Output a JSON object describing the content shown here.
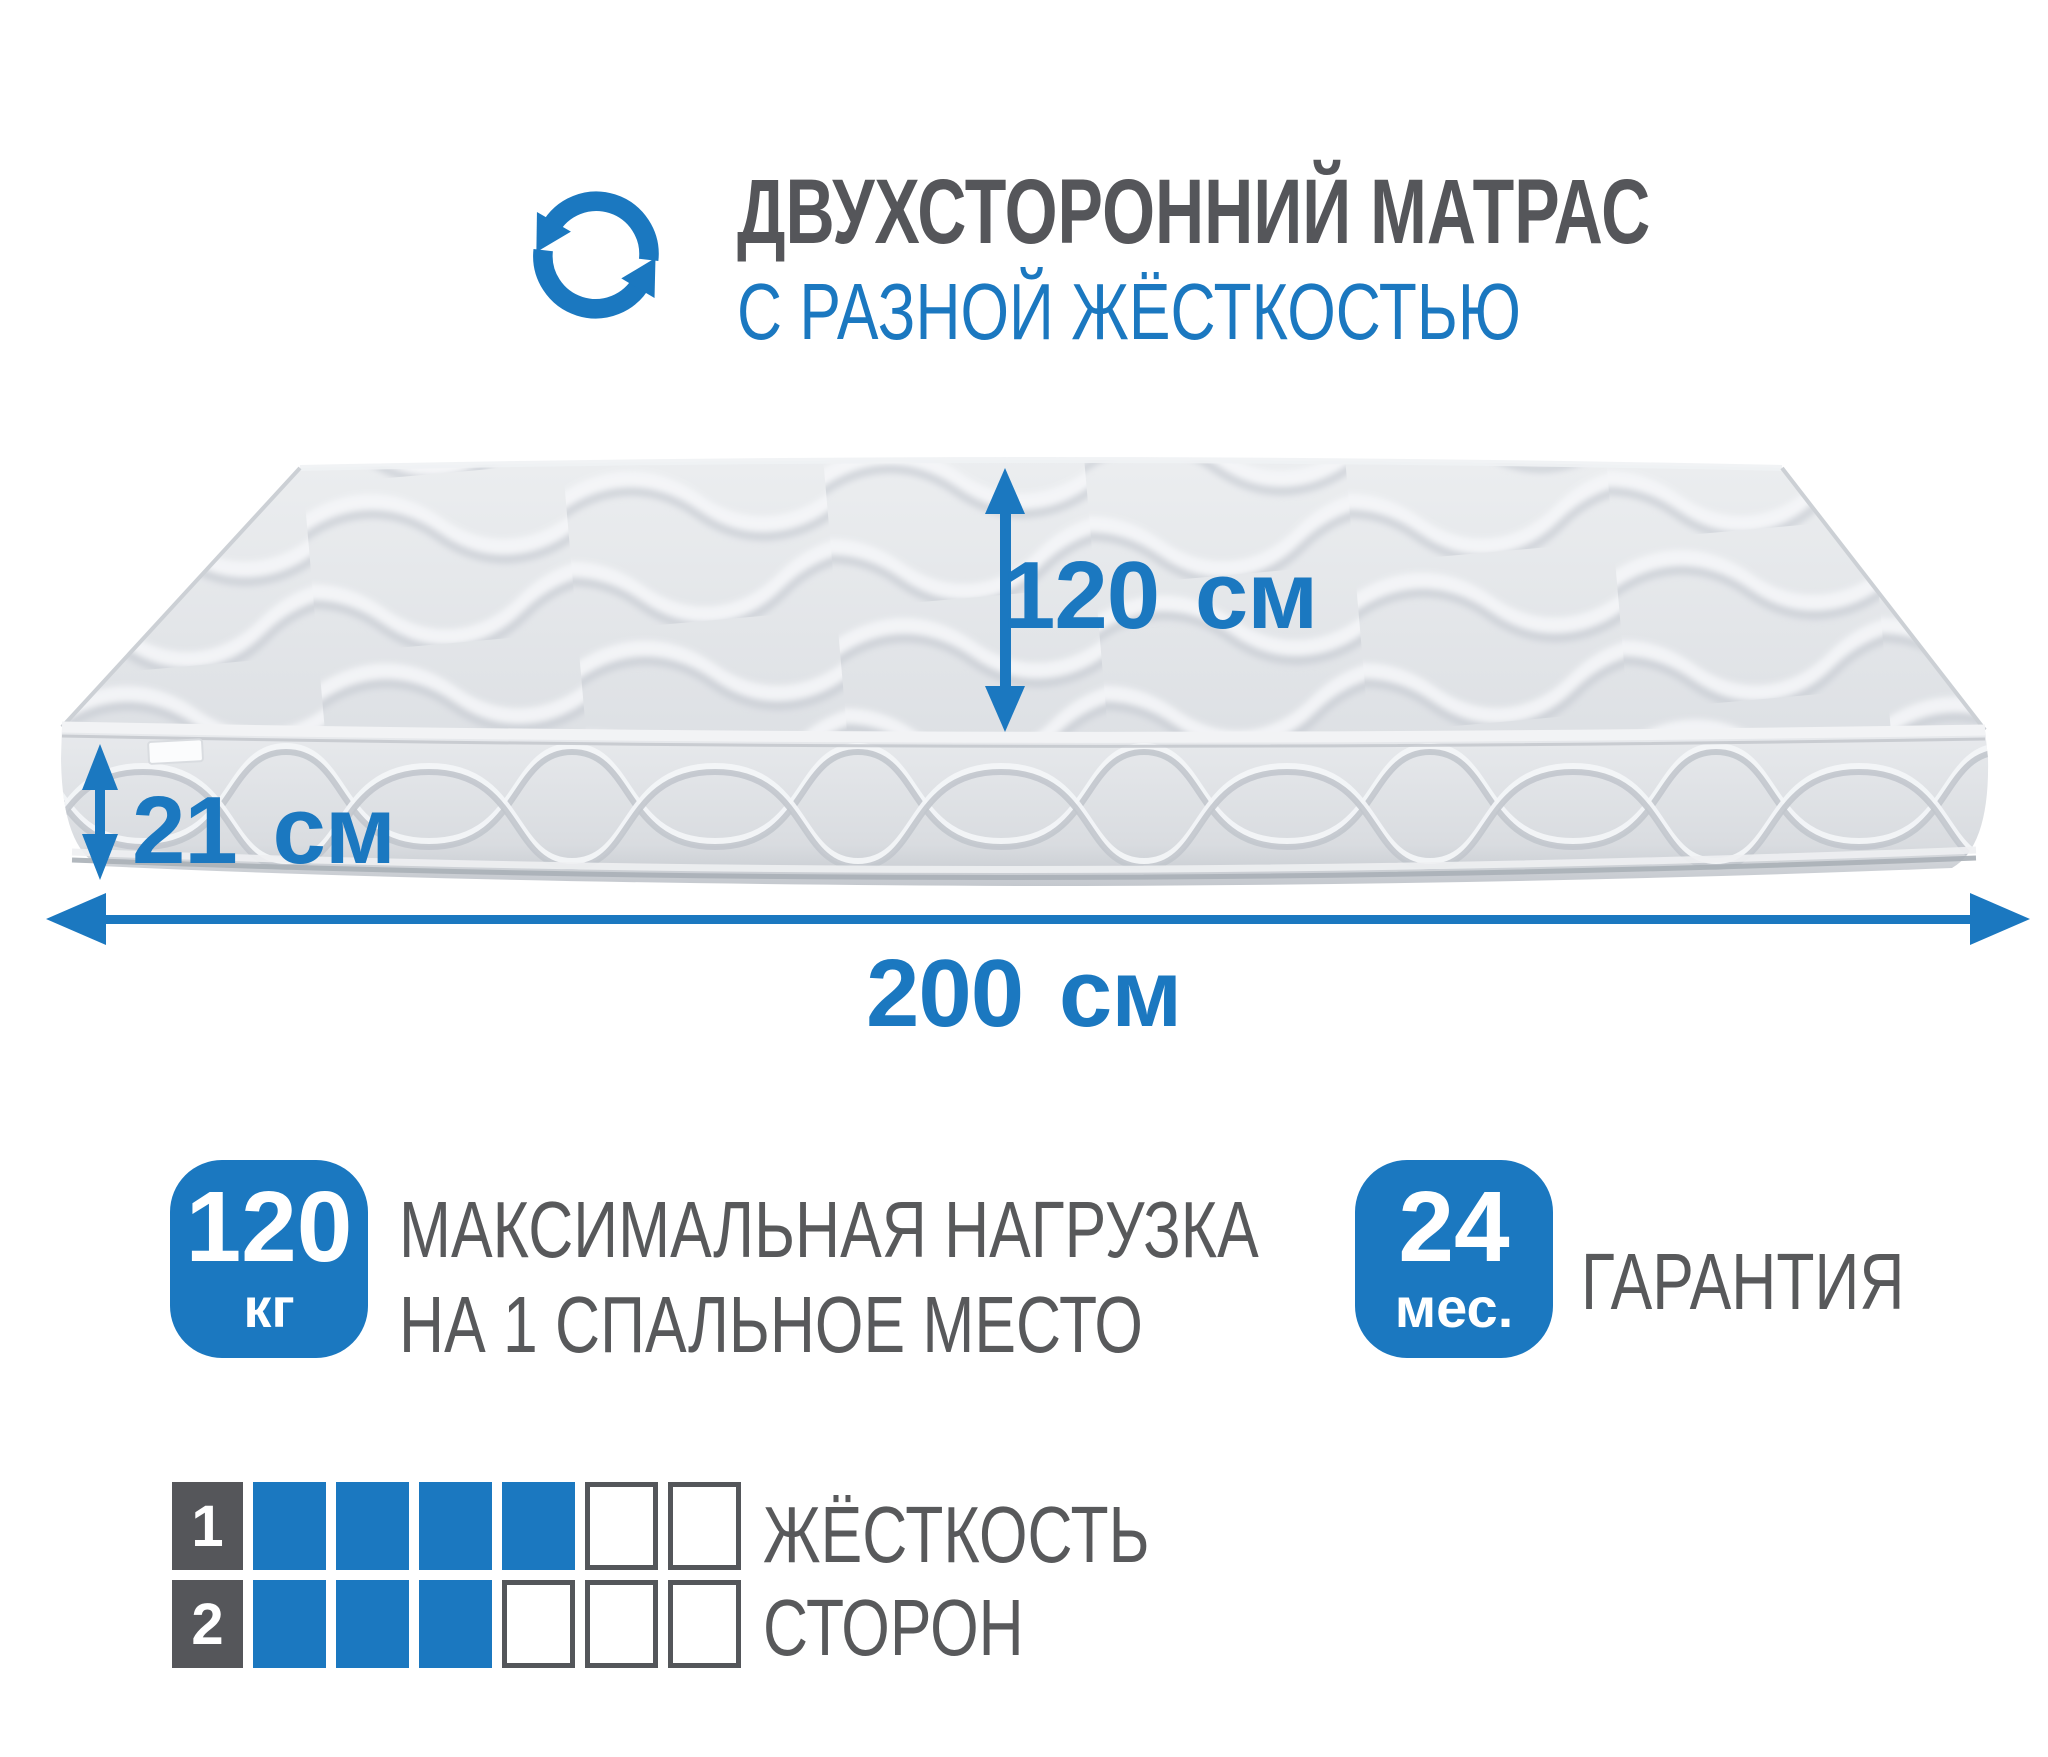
{
  "header": {
    "icon": "rotate-arrows-icon",
    "title": "ДВУХСТОРОННИЙ МАТРАС",
    "subtitle": "С РАЗНОЙ ЖЁСТКОСТЬЮ"
  },
  "mattress_diagram": {
    "width_label": "120 см",
    "thickness_label": "21 см",
    "length_label": "200 см"
  },
  "max_load": {
    "value": "120",
    "unit": "кг",
    "caption_line1": "МАКСИМАЛЬНАЯ НАГРУЗКА",
    "caption_line2": "НА 1 СПАЛЬНОЕ МЕСТО"
  },
  "warranty": {
    "value": "24",
    "unit": "мес.",
    "caption": "ГАРАНТИЯ"
  },
  "firmness": {
    "caption_line1": "ЖЁСТКОСТЬ",
    "caption_line2": "СТОРОН",
    "scale_max": 6,
    "rows": [
      {
        "side_label": "1",
        "filled": 4
      },
      {
        "side_label": "2",
        "filled": 3
      }
    ]
  },
  "colors": {
    "accent_blue": "#1b78c0",
    "text_gray": "#58595b",
    "title_gray": "#55565a",
    "mattress_top_light": "#eceef0",
    "mattress_top_dark": "#dde0e4",
    "mattress_face_dark": "#c2c6cc",
    "quilt_line": "#c6cbd2"
  }
}
